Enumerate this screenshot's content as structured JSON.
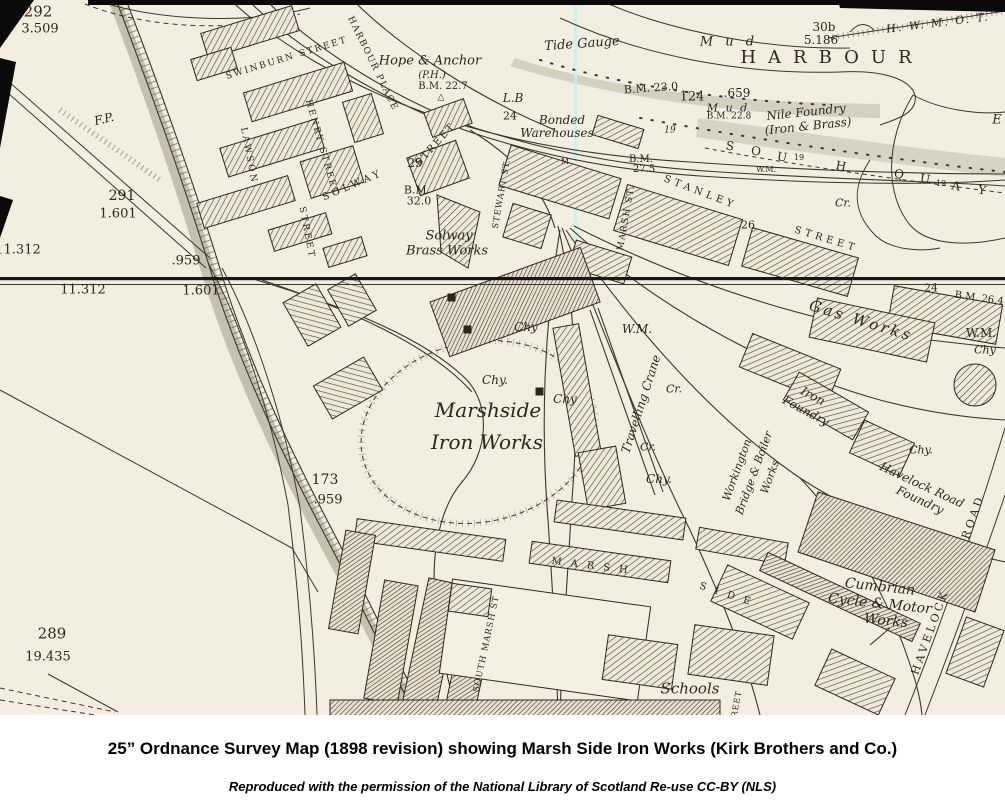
{
  "image_type": "historical-ordnance-survey-map",
  "colors": {
    "paper": "#f2efe2",
    "ink": "#2b261e",
    "mud_shading": "#b7b49e",
    "fold_line": "#cdeeea",
    "caption_text": "#000000"
  },
  "caption": {
    "title": "25” Ordnance Survey Map (1898 revision) showing Marsh Side Iron Works (Kirk Brothers and Co.)",
    "credit": "Reproduced with the permission of the National Library of Scotland  Re-use CC-BY (NLS)"
  },
  "map": {
    "labels": [
      {
        "t": "292",
        "x": 38,
        "y": 12,
        "fs": 15
      },
      {
        "t": "3.509",
        "x": 40,
        "y": 29,
        "fs": 13
      },
      {
        "t": "F.P.",
        "x": 104,
        "y": 119,
        "fs": 12,
        "i": 1,
        "rot": -14
      },
      {
        "t": "291",
        "x": 122,
        "y": 196,
        "fs": 14
      },
      {
        "t": "1.601",
        "x": 118,
        "y": 214,
        "fs": 13
      },
      {
        "t": "11.312",
        "x": 18,
        "y": 250,
        "fs": 13
      },
      {
        "t": ".959",
        "x": 186,
        "y": 261,
        "fs": 13
      },
      {
        "t": "11.312",
        "x": 83,
        "y": 290,
        "fs": 13
      },
      {
        "t": "1.601",
        "x": 201,
        "y": 291,
        "fs": 13
      },
      {
        "t": "173",
        "x": 325,
        "y": 480,
        "fs": 14
      },
      {
        "t": ".959",
        "x": 328,
        "y": 500,
        "fs": 13
      },
      {
        "t": "289",
        "x": 52,
        "y": 634,
        "fs": 15
      },
      {
        "t": "19.435",
        "x": 48,
        "y": 657,
        "fs": 13
      },
      {
        "t": "SWINBURN STREET",
        "x": 287,
        "y": 59,
        "fs": 9,
        "rot": -17,
        "ls": 2
      },
      {
        "t": "HENRY STREET",
        "x": 321,
        "y": 148,
        "fs": 9,
        "rot": 74,
        "ls": 2
      },
      {
        "t": "LAWSON",
        "x": 248,
        "y": 156,
        "fs": 9,
        "rot": 79,
        "ls": 2.5
      },
      {
        "t": "STREET",
        "x": 306,
        "y": 233,
        "fs": 9,
        "rot": 79,
        "ls": 2.5
      },
      {
        "t": "HARBOUR PLACE",
        "x": 372,
        "y": 64,
        "fs": 9,
        "rot": 64,
        "ls": 1.5
      },
      {
        "t": "SOLWAY",
        "x": 353,
        "y": 186,
        "fs": 10,
        "rot": -23,
        "ls": 3.5
      },
      {
        "t": "STREET",
        "x": 436,
        "y": 145,
        "fs": 10,
        "rot": -48,
        "ls": 2
      },
      {
        "t": "29",
        "x": 415,
        "y": 163,
        "fs": 12
      },
      {
        "t": "B.M.",
        "x": 417,
        "y": 190,
        "fs": 11
      },
      {
        "t": "32.0",
        "x": 419,
        "y": 201,
        "fs": 11
      },
      {
        "t": "Solway",
        "x": 449,
        "y": 236,
        "fs": 13,
        "i": 1
      },
      {
        "t": "Brass Works",
        "x": 447,
        "y": 251,
        "fs": 13,
        "i": 1
      },
      {
        "t": "Hope & Anchor",
        "x": 430,
        "y": 61,
        "fs": 13,
        "i": 1
      },
      {
        "t": "(P.H.)",
        "x": 432,
        "y": 76,
        "fs": 10,
        "i": 1
      },
      {
        "t": "B.M. 22.7",
        "x": 443,
        "y": 87,
        "fs": 10
      },
      {
        "t": "△",
        "x": 441,
        "y": 98,
        "fs": 9
      },
      {
        "t": "L.B",
        "x": 513,
        "y": 98,
        "fs": 12,
        "i": 1
      },
      {
        "t": "24",
        "x": 510,
        "y": 116,
        "fs": 11
      },
      {
        "t": "Tide Gauge",
        "x": 582,
        "y": 44,
        "fs": 13,
        "i": 1,
        "rot": -4
      },
      {
        "t": "B.M. 23.0",
        "x": 651,
        "y": 88,
        "fs": 11,
        "rot": -4
      },
      {
        "t": "124",
        "x": 692,
        "y": 97,
        "fs": 13
      },
      {
        "t": ".659",
        "x": 737,
        "y": 93,
        "fs": 12
      },
      {
        "t": "M u d",
        "x": 729,
        "y": 42,
        "fs": 13,
        "i": 1,
        "ls": 4
      },
      {
        "t": "HARBOUR",
        "x": 832,
        "y": 58,
        "fs": 18,
        "ls": 12
      },
      {
        "t": "30b",
        "x": 824,
        "y": 27,
        "fs": 12
      },
      {
        "t": "5.186",
        "x": 821,
        "y": 40,
        "fs": 12
      },
      {
        "t": "H. W. M. O. T.",
        "x": 938,
        "y": 23,
        "fs": 11,
        "i": 1,
        "rot": -7,
        "ls": 2
      },
      {
        "t": "M u d",
        "x": 728,
        "y": 108,
        "fs": 11,
        "i": 1,
        "ls": 2
      },
      {
        "t": "B.M. 22.8",
        "x": 729,
        "y": 117,
        "fs": 9
      },
      {
        "t": "Nile Foundry",
        "x": 806,
        "y": 112,
        "fs": 12,
        "i": 1,
        "rot": -6
      },
      {
        "t": "(Iron & Brass)",
        "x": 808,
        "y": 126,
        "fs": 12,
        "i": 1,
        "rot": -6
      },
      {
        "t": "E",
        "x": 997,
        "y": 120,
        "fs": 13,
        "i": 1
      },
      {
        "t": "S",
        "x": 730,
        "y": 146,
        "fs": 12,
        "rot": 10
      },
      {
        "t": "O",
        "x": 756,
        "y": 151,
        "fs": 12,
        "rot": 10
      },
      {
        "t": "U",
        "x": 782,
        "y": 157,
        "fs": 12,
        "rot": 10
      },
      {
        "t": "19",
        "x": 799,
        "y": 158,
        "fs": 8
      },
      {
        "t": "H",
        "x": 841,
        "y": 166,
        "fs": 12,
        "rot": 10
      },
      {
        "t": "Q",
        "x": 899,
        "y": 174,
        "fs": 12,
        "rot": 10
      },
      {
        "t": "U",
        "x": 925,
        "y": 179,
        "fs": 12,
        "rot": 10
      },
      {
        "t": "19",
        "x": 941,
        "y": 184,
        "fs": 8
      },
      {
        "t": "A",
        "x": 956,
        "y": 186,
        "fs": 12,
        "rot": 10
      },
      {
        "t": "Y",
        "x": 982,
        "y": 190,
        "fs": 12,
        "rot": 10
      },
      {
        "t": "Cr.",
        "x": 843,
        "y": 203,
        "fs": 11,
        "i": 1
      },
      {
        "t": "W.M.",
        "x": 766,
        "y": 170,
        "fs": 8
      },
      {
        "t": "M",
        "x": 565,
        "y": 162,
        "fs": 8
      },
      {
        "t": "B.M.",
        "x": 641,
        "y": 160,
        "fs": 10
      },
      {
        "t": "27.5",
        "x": 644,
        "y": 170,
        "fs": 10
      },
      {
        "t": "Bonded",
        "x": 562,
        "y": 120,
        "fs": 12,
        "i": 1
      },
      {
        "t": "Warehouses",
        "x": 557,
        "y": 133,
        "fs": 12,
        "i": 1
      },
      {
        "t": "19",
        "x": 670,
        "y": 131,
        "fs": 9,
        "i": 1
      },
      {
        "t": "MARSH ST.",
        "x": 627,
        "y": 218,
        "fs": 9,
        "rot": -80,
        "ls": 1.5
      },
      {
        "t": "STANLEY",
        "x": 700,
        "y": 193,
        "fs": 10,
        "rot": 21,
        "ls": 4
      },
      {
        "t": "STREET",
        "x": 826,
        "y": 240,
        "fs": 10,
        "rot": 17,
        "ls": 4
      },
      {
        "t": "26",
        "x": 748,
        "y": 225,
        "fs": 11
      },
      {
        "t": "STEWART ST.",
        "x": 502,
        "y": 194,
        "fs": 8.5,
        "rot": -80,
        "ls": 1
      },
      {
        "t": "24",
        "x": 931,
        "y": 288,
        "fs": 11
      },
      {
        "t": "B.M. 26.4",
        "x": 979,
        "y": 299,
        "fs": 10,
        "rot": 8
      },
      {
        "t": "Gas Works",
        "x": 861,
        "y": 321,
        "fs": 15,
        "i": 1,
        "rot": 17,
        "ls": 3
      },
      {
        "t": "W.M.",
        "x": 981,
        "y": 333,
        "fs": 12
      },
      {
        "t": "Chy",
        "x": 985,
        "y": 350,
        "fs": 11,
        "i": 1
      },
      {
        "t": "Iron",
        "x": 813,
        "y": 396,
        "fs": 12,
        "i": 1,
        "rot": 28
      },
      {
        "t": "Foundry",
        "x": 806,
        "y": 411,
        "fs": 12,
        "i": 1,
        "rot": 28
      },
      {
        "t": "Chy.",
        "x": 921,
        "y": 450,
        "fs": 11,
        "i": 1
      },
      {
        "t": "Havelock Road",
        "x": 922,
        "y": 485,
        "fs": 12,
        "i": 1,
        "rot": 25
      },
      {
        "t": "Foundry",
        "x": 920,
        "y": 500,
        "fs": 12,
        "i": 1,
        "rot": 25
      },
      {
        "t": "W.M.",
        "x": 637,
        "y": 329,
        "fs": 12,
        "i": 1
      },
      {
        "t": "Chy",
        "x": 526,
        "y": 327,
        "fs": 12,
        "i": 1
      },
      {
        "t": "Chy.",
        "x": 495,
        "y": 380,
        "fs": 12,
        "i": 1
      },
      {
        "t": "Chy",
        "x": 565,
        "y": 399,
        "fs": 12,
        "i": 1
      },
      {
        "t": "Chy.",
        "x": 659,
        "y": 479,
        "fs": 12,
        "i": 1
      },
      {
        "t": "Cr.",
        "x": 674,
        "y": 389,
        "fs": 11,
        "i": 1
      },
      {
        "t": "Cr.",
        "x": 648,
        "y": 447,
        "fs": 11,
        "i": 1
      },
      {
        "t": "Marshside",
        "x": 488,
        "y": 410,
        "fs": 20,
        "i": 1
      },
      {
        "t": "Iron Works",
        "x": 487,
        "y": 442,
        "fs": 20,
        "i": 1
      },
      {
        "t": "Travelling Crane",
        "x": 641,
        "y": 404,
        "fs": 12,
        "i": 1,
        "rot": -72
      },
      {
        "t": "Workington",
        "x": 737,
        "y": 470,
        "fs": 11,
        "i": 1,
        "rot": -70
      },
      {
        "t": "Bridge & Boiler",
        "x": 754,
        "y": 473,
        "fs": 11,
        "i": 1,
        "rot": -70
      },
      {
        "t": "Works",
        "x": 770,
        "y": 477,
        "fs": 11,
        "i": 1,
        "rot": -70
      },
      {
        "t": "MARSH",
        "x": 594,
        "y": 567,
        "fs": 10,
        "rot": 7,
        "ls": 9
      },
      {
        "t": "SIDE",
        "x": 729,
        "y": 596,
        "fs": 10,
        "rot": 18,
        "ls": 9
      },
      {
        "t": "SOUTH MARSH ST",
        "x": 487,
        "y": 644,
        "fs": 8.5,
        "rot": -78,
        "ls": 1
      },
      {
        "t": "Cumbrian",
        "x": 880,
        "y": 587,
        "fs": 14,
        "i": 1,
        "rot": 6
      },
      {
        "t": "Cycle & Motor",
        "x": 880,
        "y": 604,
        "fs": 14,
        "i": 1,
        "rot": 6
      },
      {
        "t": "Works",
        "x": 886,
        "y": 621,
        "fs": 14,
        "i": 1,
        "rot": 6
      },
      {
        "t": "HAVELOCK",
        "x": 930,
        "y": 632,
        "fs": 11,
        "rot": -70,
        "ls": 3
      },
      {
        "t": "ROAD",
        "x": 973,
        "y": 517,
        "fs": 11,
        "rot": -70,
        "ls": 3
      },
      {
        "t": "Schools",
        "x": 690,
        "y": 689,
        "fs": 15,
        "i": 1
      },
      {
        "t": "REET",
        "x": 737,
        "y": 704,
        "fs": 8,
        "rot": -80,
        "ls": 1
      }
    ]
  }
}
